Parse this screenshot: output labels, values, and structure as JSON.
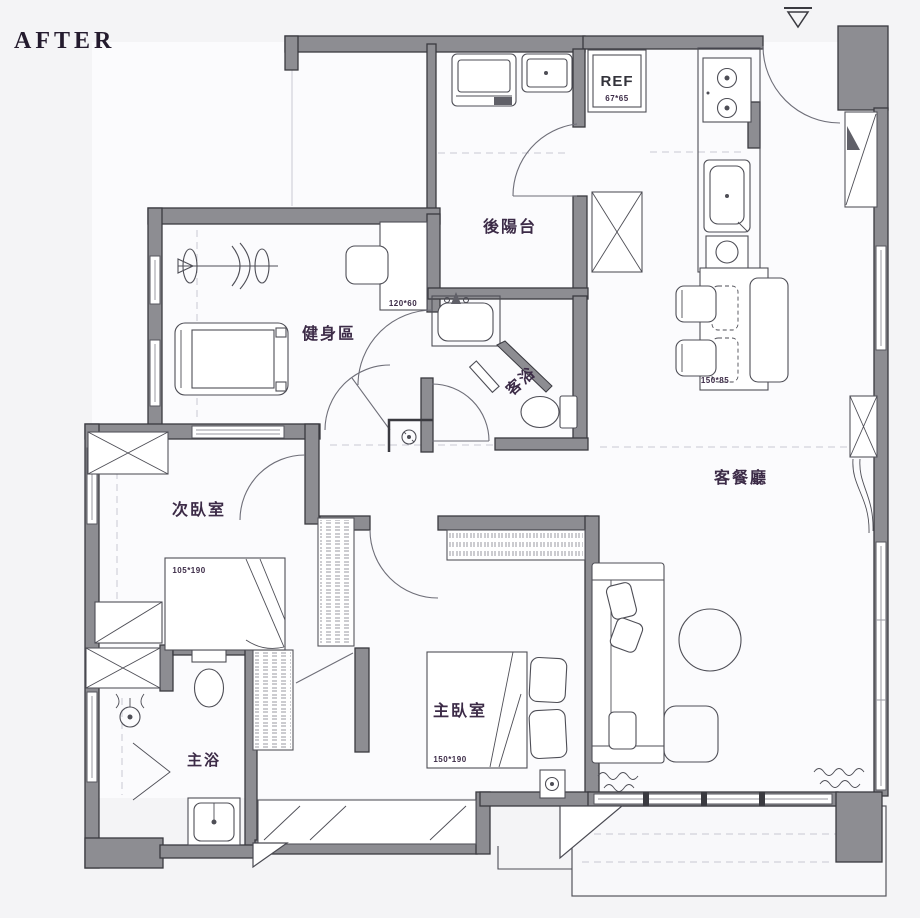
{
  "title": "AFTER",
  "colors": {
    "wall": "#8d8d92",
    "wall_stroke": "#3a3a40",
    "line": "#4e4e56",
    "text": "#3c2b47",
    "background": "#f4f4f6"
  },
  "rooms": {
    "back_balcony": {
      "label": "後陽台"
    },
    "gym": {
      "label": "健身區",
      "desk_dim": "120*60"
    },
    "guest_bath": {
      "label": "客浴"
    },
    "second_bedroom": {
      "label": "次臥室",
      "bed_dim": "105*190"
    },
    "master_bath": {
      "label": "主浴"
    },
    "master_bedroom": {
      "label": "主臥室",
      "bed_dim": "150*190"
    },
    "living_dining": {
      "label": "客餐廳",
      "dining_table_dim": "150*85"
    },
    "kitchen": {
      "fridge_label": "REF",
      "fridge_dim": "67*65"
    }
  }
}
